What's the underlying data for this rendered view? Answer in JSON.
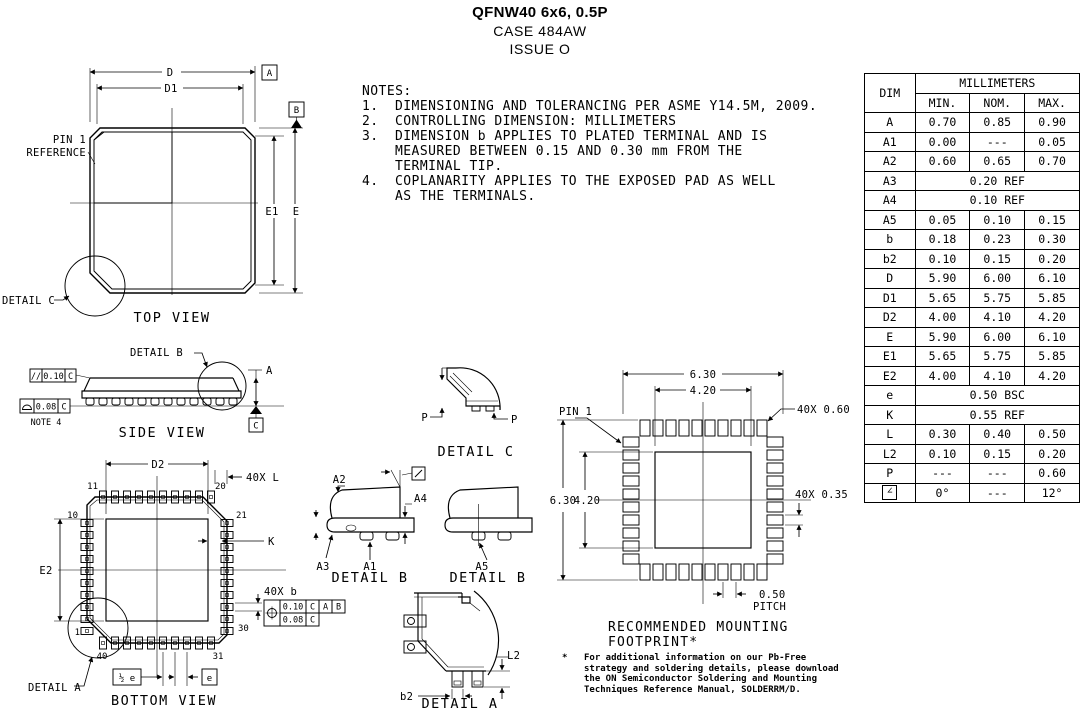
{
  "title": {
    "product": "QFNW40 6x6, 0.5P",
    "case": "CASE 484AW",
    "issue": "ISSUE O"
  },
  "notes": {
    "heading": "NOTES:",
    "items": [
      {
        "num": "1.",
        "lines": [
          "DIMENSIONING AND TOLERANCING PER ASME Y14.5M, 2009."
        ]
      },
      {
        "num": "2.",
        "lines": [
          "CONTROLLING DIMENSION: MILLIMETERS"
        ]
      },
      {
        "num": "3.",
        "lines": [
          "DIMENSION b APPLIES TO PLATED TERMINAL AND IS",
          "MEASURED BETWEEN 0.15 AND 0.30 mm FROM THE",
          "TERMINAL TIP."
        ]
      },
      {
        "num": "4.",
        "lines": [
          "COPLANARITY APPLIES TO THE EXPOSED PAD AS WELL",
          "AS THE TERMINALS."
        ]
      }
    ]
  },
  "dim_table": {
    "unit_header": "MILLIMETERS",
    "dim_header": "DIM",
    "columns": [
      "MIN.",
      "NOM.",
      "MAX."
    ],
    "rows": [
      {
        "dim": "A",
        "min": "0.70",
        "nom": "0.85",
        "max": "0.90"
      },
      {
        "dim": "A1",
        "min": "0.00",
        "nom": "---",
        "max": "0.05"
      },
      {
        "dim": "A2",
        "min": "0.60",
        "nom": "0.65",
        "max": "0.70"
      },
      {
        "dim": "A3",
        "span": "0.20 REF"
      },
      {
        "dim": "A4",
        "span": "0.10 REF"
      },
      {
        "dim": "A5",
        "min": "0.05",
        "nom": "0.10",
        "max": "0.15"
      },
      {
        "dim": "b",
        "min": "0.18",
        "nom": "0.23",
        "max": "0.30"
      },
      {
        "dim": "b2",
        "min": "0.10",
        "nom": "0.15",
        "max": "0.20"
      },
      {
        "dim": "D",
        "min": "5.90",
        "nom": "6.00",
        "max": "6.10"
      },
      {
        "dim": "D1",
        "min": "5.65",
        "nom": "5.75",
        "max": "5.85"
      },
      {
        "dim": "D2",
        "min": "4.00",
        "nom": "4.10",
        "max": "4.20"
      },
      {
        "dim": "E",
        "min": "5.90",
        "nom": "6.00",
        "max": "6.10"
      },
      {
        "dim": "E1",
        "min": "5.65",
        "nom": "5.75",
        "max": "5.85"
      },
      {
        "dim": "E2",
        "min": "4.00",
        "nom": "4.10",
        "max": "4.20"
      },
      {
        "dim": "e",
        "span": "0.50 BSC"
      },
      {
        "dim": "K",
        "span": "0.55 REF"
      },
      {
        "dim": "L",
        "min": "0.30",
        "nom": "0.40",
        "max": "0.50"
      },
      {
        "dim": "L2",
        "min": "0.10",
        "nom": "0.15",
        "max": "0.20"
      },
      {
        "dim": "P",
        "min": "---",
        "nom": "---",
        "max": "0.60"
      },
      {
        "dim": "∠",
        "boxed": true,
        "min": "0°",
        "nom": "---",
        "max": "12°"
      }
    ]
  },
  "top_view": {
    "caption": "TOP VIEW",
    "dim_d": "D",
    "dim_d1": "D1",
    "dim_e": "E",
    "dim_e1": "E1",
    "datum_a": "A",
    "datum_b": "B",
    "pin1_line1": "PIN 1",
    "pin1_line2": "REFERENCE",
    "detail_c_ref": "DETAIL C"
  },
  "side_view": {
    "caption": "SIDE VIEW",
    "detail_b_ref": "DETAIL B",
    "dim_a": "A",
    "datum_c": "C",
    "fcf_parallelism": {
      "symbol": "//",
      "value": "0.10",
      "datum": "C"
    },
    "fcf_coplanarity": {
      "value": "0.08",
      "datum": "C"
    },
    "note_ref": "NOTE 4"
  },
  "bottom_view": {
    "caption": "BOTTOM VIEW",
    "dim_d2": "D2",
    "dim_e2": "E2",
    "dim_k": "K",
    "label_40x_l": "40X L",
    "label_40x_b": "40X b",
    "fcf_position": {
      "value1": "0.10",
      "datums1": [
        "C",
        "A",
        "B"
      ],
      "value2": "0.08",
      "datum2": "C"
    },
    "half_pitch": "½ e",
    "pitch": "e",
    "pins": {
      "p1": "1",
      "p10": "10",
      "p11": "11",
      "p20": "20",
      "p21": "21",
      "p30": "30",
      "p31": "31",
      "p40": "40"
    },
    "detail_a_ref": "DETAIL A"
  },
  "detail_c": {
    "caption": "DETAIL C",
    "dim_p_left": "P",
    "dim_p_right": "P"
  },
  "detail_b_left": {
    "caption": "DETAIL B",
    "dim_a1": "A1",
    "dim_a2": "A2",
    "dim_a3": "A3",
    "dim_a4": "A4"
  },
  "detail_b_right": {
    "caption": "DETAIL B",
    "dim_a5": "A5"
  },
  "detail_a": {
    "caption": "DETAIL A",
    "dim_b2": "b2",
    "dim_l2": "L2"
  },
  "footprint": {
    "caption_line1": "RECOMMENDED MOUNTING",
    "caption_line2": "FOOTPRINT*",
    "pin1": "PIN 1",
    "dim_top_outer": "6.30",
    "dim_top_inner": "4.20",
    "dim_left_outer": "6.30",
    "dim_left_inner": "4.20",
    "pad_length": "40X 0.60",
    "pad_width": "40X 0.35",
    "pitch_value": "0.50",
    "pitch_label": "PITCH",
    "note_marker": "*",
    "note_lines": [
      "For additional information on our Pb-Free",
      "strategy and soldering details, please download",
      "the ON Semiconductor Soldering and Mounting",
      "Techniques Reference Manual, SOLDERRM/D."
    ]
  }
}
